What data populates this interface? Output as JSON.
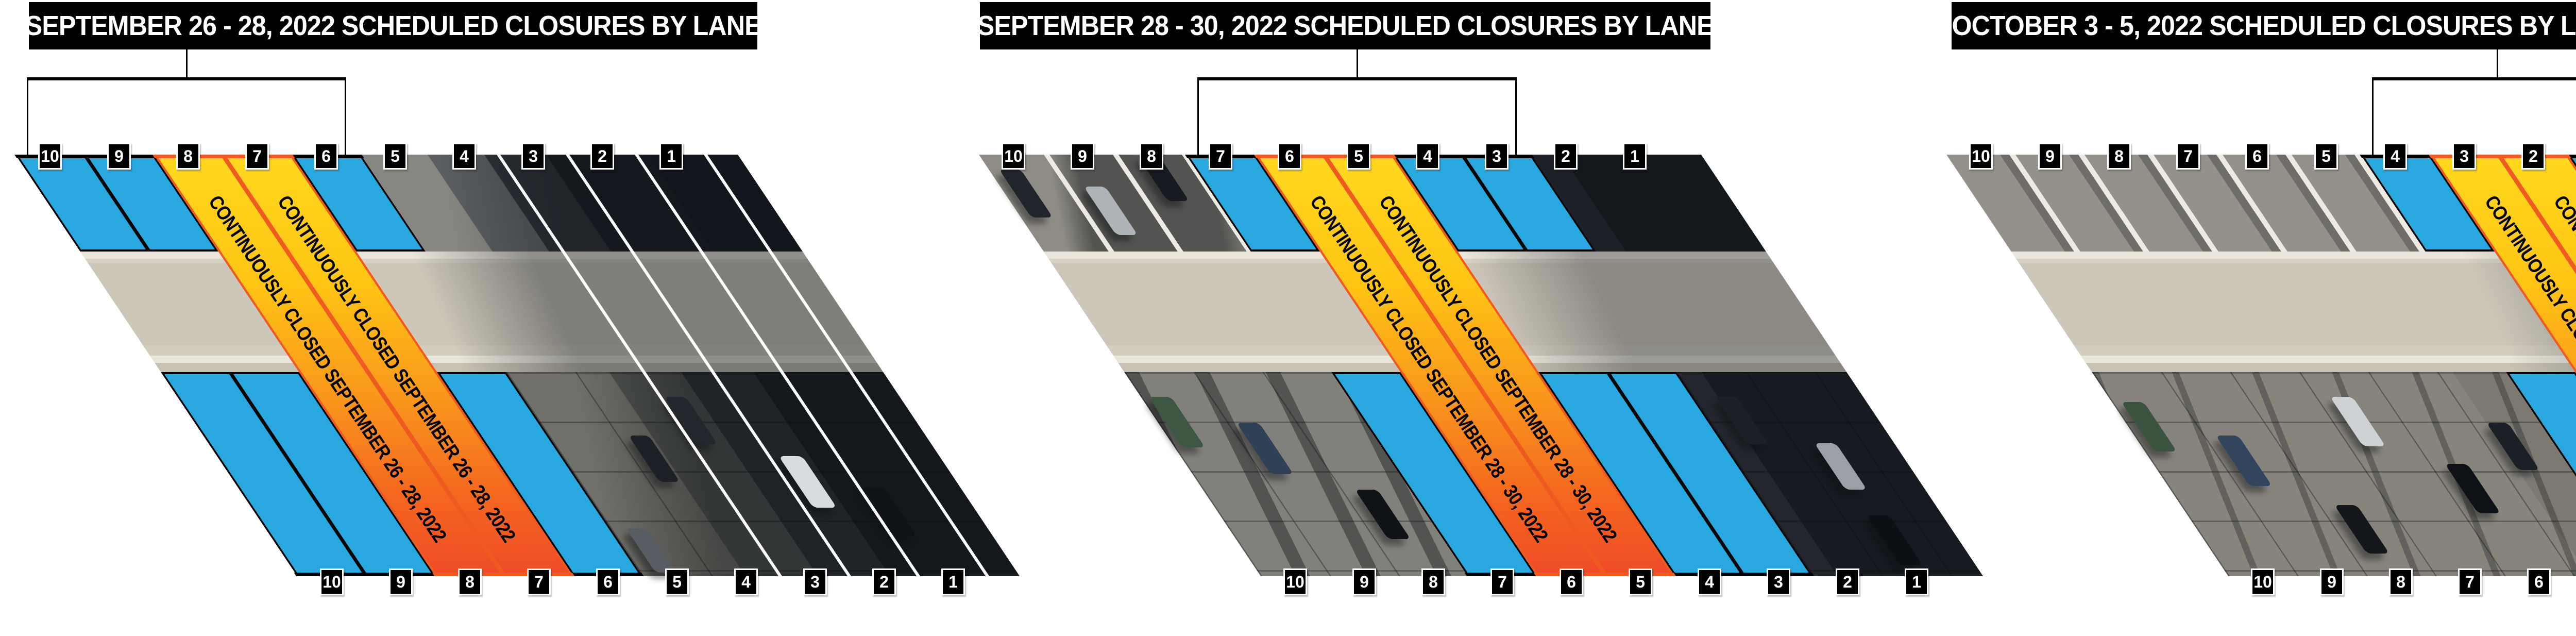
{
  "page": {
    "background": "#FFFFFF"
  },
  "colors": {
    "title_bg": "#000000",
    "title_text": "#FFFFFF",
    "label_bg": "#000000",
    "label_text": "#FFFFFF",
    "blue_closed": "#29A8E0",
    "yellow_closed_top": "#FFD81F",
    "orange_closed_bottom": "#F04B27",
    "closure_border_orange": "#F2591F",
    "outline_black": "#000000",
    "open_lane_line_white": "#FFFFFF"
  },
  "panels": [
    {
      "title": "SEPTEMBER 26 - 28, 2022 SCHEDULED CLOSURES BY LANE",
      "continuous_closure_label": "CONTINUOUSLY CLOSED SEPTEMBER 26 - 28, 2022",
      "bracket": {
        "from_lane": 10,
        "to_lane": 6
      },
      "lanes": [
        {
          "number": 10,
          "status": "closed"
        },
        {
          "number": 9,
          "status": "closed"
        },
        {
          "number": 8,
          "status": "continuous"
        },
        {
          "number": 7,
          "status": "continuous"
        },
        {
          "number": 6,
          "status": "closed"
        },
        {
          "number": 5,
          "status": "open"
        },
        {
          "number": 4,
          "status": "open"
        },
        {
          "number": 3,
          "status": "open"
        },
        {
          "number": 2,
          "status": "open"
        },
        {
          "number": 1,
          "status": "open"
        }
      ],
      "white_divider_right_of_lanes": [
        4,
        3,
        2,
        1
      ]
    },
    {
      "title": "SEPTEMBER 28 - 30, 2022 SCHEDULED CLOSURES BY LANE",
      "continuous_closure_label": "CONTINUOUSLY CLOSED SEPTEMBER 28 - 30, 2022",
      "bracket": {
        "from_lane": 7,
        "to_lane": 3
      },
      "lanes": [
        {
          "number": 10,
          "status": "open"
        },
        {
          "number": 9,
          "status": "open"
        },
        {
          "number": 8,
          "status": "open"
        },
        {
          "number": 7,
          "status": "closed"
        },
        {
          "number": 6,
          "status": "continuous"
        },
        {
          "number": 5,
          "status": "continuous"
        },
        {
          "number": 4,
          "status": "closed"
        },
        {
          "number": 3,
          "status": "closed"
        },
        {
          "number": 2,
          "status": "open"
        },
        {
          "number": 1,
          "status": "open"
        }
      ],
      "white_divider_right_of_lanes": []
    },
    {
      "title": "OCTOBER 3 - 5, 2022 SCHEDULED CLOSURES BY LANE",
      "continuous_closure_label": "CONTINUOUSLY CLOSED OCTOBER 3 - 5, 2022",
      "bracket": {
        "from_lane": 4,
        "to_lane": 1
      },
      "lanes": [
        {
          "number": 10,
          "status": "open"
        },
        {
          "number": 9,
          "status": "open"
        },
        {
          "number": 8,
          "status": "open"
        },
        {
          "number": 7,
          "status": "open"
        },
        {
          "number": 6,
          "status": "open"
        },
        {
          "number": 5,
          "status": "open"
        },
        {
          "number": 4,
          "status": "closed"
        },
        {
          "number": 3,
          "status": "continuous"
        },
        {
          "number": 2,
          "status": "continuous"
        },
        {
          "number": 1,
          "status": "closed"
        }
      ],
      "white_divider_right_of_lanes": []
    }
  ]
}
